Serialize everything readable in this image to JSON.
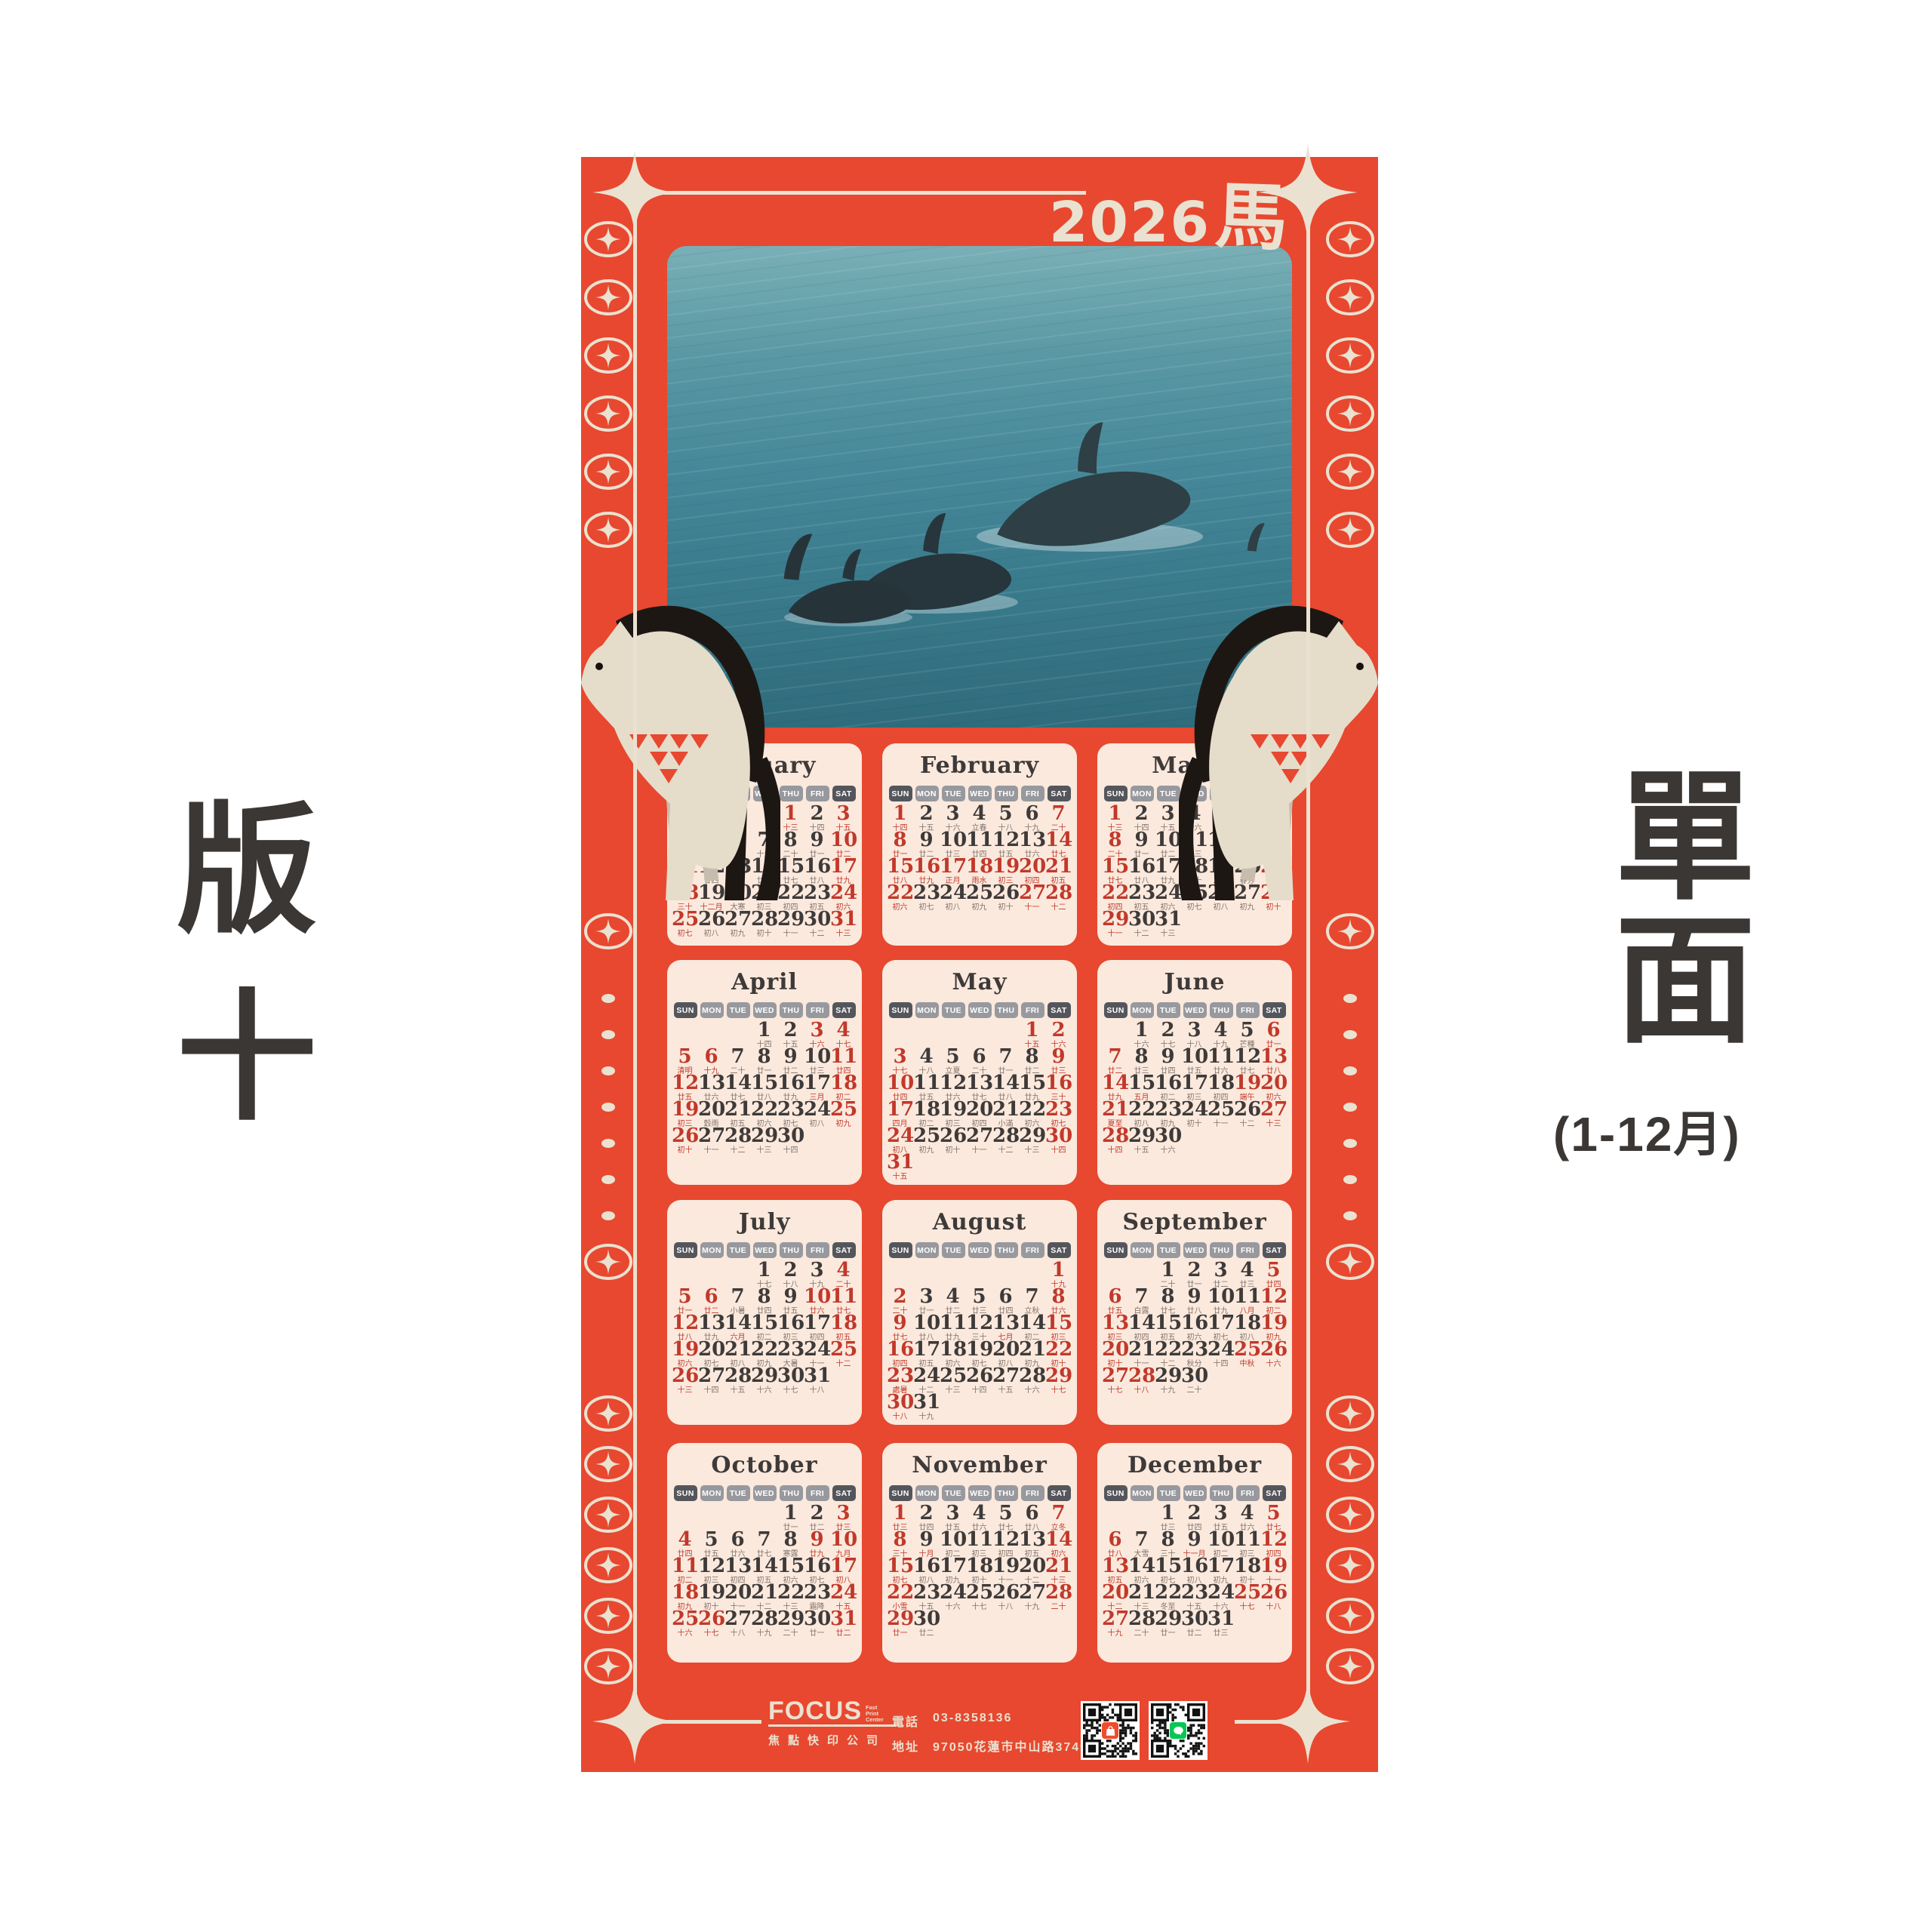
{
  "page": {
    "side_left": [
      "版",
      "十"
    ],
    "side_right": [
      "單",
      "面"
    ],
    "side_right_note": "(1-12月)"
  },
  "poster": {
    "year": "2026",
    "zodiac": "馬"
  },
  "weekdays": [
    "SUN",
    "MON",
    "TUE",
    "WED",
    "THU",
    "FRI",
    "SAT"
  ],
  "months": [
    {
      "name": "January",
      "first_dow": 4,
      "days": 31,
      "red": [
        1,
        3,
        4,
        10,
        11,
        17,
        18,
        24,
        25,
        31
      ],
      "lunar": [
        "十三",
        "十四",
        "十五",
        "十六",
        "十七",
        "十八",
        "十九",
        "二十",
        "廿一",
        "廿二",
        "廿三",
        "廿四",
        "廿五",
        "廿六",
        "廿七",
        "廿八",
        "廿九",
        "三十",
        "十二月",
        "大寒",
        "初三",
        "初四",
        "初五",
        "初六",
        "初七",
        "初八",
        "初九",
        "初十",
        "十一",
        "十二",
        "十三"
      ]
    },
    {
      "name": "February",
      "first_dow": 0,
      "days": 28,
      "red": [
        1,
        7,
        8,
        14,
        15,
        16,
        17,
        18,
        19,
        20,
        21,
        22,
        27,
        28
      ],
      "lunar": [
        "十四",
        "十五",
        "十六",
        "立春",
        "十八",
        "十九",
        "二十",
        "廿一",
        "廿二",
        "廿三",
        "廿四",
        "廿五",
        "廿六",
        "廿七",
        "廿八",
        "廿九",
        "正月",
        "雨水",
        "初三",
        "初四",
        "初五",
        "初六",
        "初七",
        "初八",
        "初九",
        "初十",
        "十一",
        "十二"
      ]
    },
    {
      "name": "March",
      "first_dow": 0,
      "days": 31,
      "red": [
        1,
        7,
        8,
        14,
        15,
        21,
        22,
        28,
        29
      ],
      "lunar": [
        "十三",
        "十四",
        "十五",
        "十六",
        "驚蟄",
        "十八",
        "十九",
        "二十",
        "廿一",
        "廿二",
        "廿三",
        "廿四",
        "廿五",
        "廿六",
        "廿七",
        "廿八",
        "廿九",
        "三十",
        "二月",
        "春分",
        "初三",
        "初四",
        "初五",
        "初六",
        "初七",
        "初八",
        "初九",
        "初十",
        "十一",
        "十二",
        "十三"
      ]
    },
    {
      "name": "April",
      "first_dow": 3,
      "days": 30,
      "red": [
        3,
        4,
        5,
        6,
        11,
        12,
        18,
        19,
        25,
        26
      ],
      "lunar": [
        "十四",
        "十五",
        "十六",
        "十七",
        "清明",
        "十九",
        "二十",
        "廿一",
        "廿二",
        "廿三",
        "廿四",
        "廿五",
        "廿六",
        "廿七",
        "廿八",
        "廿九",
        "三月",
        "初二",
        "初三",
        "穀雨",
        "初五",
        "初六",
        "初七",
        "初八",
        "初九",
        "初十",
        "十一",
        "十二",
        "十三",
        "十四"
      ]
    },
    {
      "name": "May",
      "first_dow": 5,
      "days": 31,
      "red": [
        1,
        2,
        3,
        9,
        10,
        16,
        17,
        23,
        24,
        30,
        31
      ],
      "lunar": [
        "十五",
        "十六",
        "十七",
        "十八",
        "立夏",
        "二十",
        "廿一",
        "廿二",
        "廿三",
        "廿四",
        "廿五",
        "廿六",
        "廿七",
        "廿八",
        "廿九",
        "三十",
        "四月",
        "初二",
        "初三",
        "初四",
        "小滿",
        "初六",
        "初七",
        "初八",
        "初九",
        "初十",
        "十一",
        "十二",
        "十三",
        "十四",
        "十五"
      ]
    },
    {
      "name": "June",
      "first_dow": 1,
      "days": 30,
      "red": [
        6,
        7,
        13,
        14,
        19,
        20,
        21,
        27,
        28
      ],
      "lunar": [
        "十六",
        "十七",
        "十八",
        "十九",
        "芒種",
        "廿一",
        "廿二",
        "廿三",
        "廿四",
        "廿五",
        "廿六",
        "廿七",
        "廿八",
        "廿九",
        "五月",
        "初二",
        "初三",
        "初四",
        "端午",
        "初六",
        "夏至",
        "初八",
        "初九",
        "初十",
        "十一",
        "十二",
        "十三",
        "十四",
        "十五",
        "十六"
      ]
    },
    {
      "name": "July",
      "first_dow": 3,
      "days": 31,
      "red": [
        4,
        5,
        6,
        10,
        11,
        12,
        18,
        19,
        25,
        26
      ],
      "lunar": [
        "十七",
        "十八",
        "十九",
        "二十",
        "廿一",
        "廿二",
        "小暑",
        "廿四",
        "廿五",
        "廿六",
        "廿七",
        "廿八",
        "廿九",
        "六月",
        "初二",
        "初三",
        "初四",
        "初五",
        "初六",
        "初七",
        "初八",
        "初九",
        "大暑",
        "十一",
        "十二",
        "十三",
        "十四",
        "十五",
        "十六",
        "十七",
        "十八"
      ]
    },
    {
      "name": "August",
      "first_dow": 6,
      "days": 31,
      "red": [
        1,
        2,
        8,
        9,
        15,
        16,
        22,
        23,
        29,
        30
      ],
      "lunar": [
        "十九",
        "二十",
        "廿一",
        "廿二",
        "廿三",
        "廿四",
        "立秋",
        "廿六",
        "廿七",
        "廿八",
        "廿九",
        "三十",
        "七月",
        "初二",
        "初三",
        "初四",
        "初五",
        "初六",
        "初七",
        "初八",
        "初九",
        "初十",
        "處暑",
        "十二",
        "十三",
        "十四",
        "十五",
        "十六",
        "十七",
        "十八",
        "十九"
      ]
    },
    {
      "name": "September",
      "first_dow": 2,
      "days": 30,
      "red": [
        5,
        6,
        12,
        13,
        19,
        20,
        25,
        26,
        27,
        28
      ],
      "lunar": [
        "二十",
        "廿一",
        "廿二",
        "廿三",
        "廿四",
        "廿五",
        "白露",
        "廿七",
        "廿八",
        "廿九",
        "八月",
        "初二",
        "初三",
        "初四",
        "初五",
        "初六",
        "初七",
        "初八",
        "初九",
        "初十",
        "十一",
        "十二",
        "秋分",
        "十四",
        "中秋",
        "十六",
        "十七",
        "十八",
        "十九",
        "二十"
      ]
    },
    {
      "name": "October",
      "first_dow": 4,
      "days": 31,
      "red": [
        3,
        4,
        9,
        10,
        11,
        17,
        18,
        24,
        25,
        26,
        31
      ],
      "lunar": [
        "廿一",
        "廿二",
        "廿三",
        "廿四",
        "廿五",
        "廿六",
        "廿七",
        "寒露",
        "廿九",
        "九月",
        "初二",
        "初三",
        "初四",
        "初五",
        "初六",
        "初七",
        "初八",
        "初九",
        "初十",
        "十一",
        "十二",
        "十三",
        "霜降",
        "十五",
        "十六",
        "十七",
        "十八",
        "十九",
        "二十",
        "廿一",
        "廿二"
      ]
    },
    {
      "name": "November",
      "first_dow": 0,
      "days": 30,
      "red": [
        1,
        7,
        8,
        14,
        15,
        21,
        22,
        28,
        29
      ],
      "lunar": [
        "廿三",
        "廿四",
        "廿五",
        "廿六",
        "廿七",
        "廿八",
        "立冬",
        "三十",
        "十月",
        "初二",
        "初三",
        "初四",
        "初五",
        "初六",
        "初七",
        "初八",
        "初九",
        "初十",
        "十一",
        "十二",
        "十三",
        "小雪",
        "十五",
        "十六",
        "十七",
        "十八",
        "十九",
        "二十",
        "廿一",
        "廿二"
      ]
    },
    {
      "name": "December",
      "first_dow": 2,
      "days": 31,
      "red": [
        5,
        6,
        12,
        13,
        19,
        20,
        25,
        26,
        27
      ],
      "lunar": [
        "廿三",
        "廿四",
        "廿五",
        "廿六",
        "廿七",
        "廿八",
        "大雪",
        "三十",
        "十一月",
        "初二",
        "初三",
        "初四",
        "初五",
        "初六",
        "初七",
        "初八",
        "初九",
        "初十",
        "十一",
        "十二",
        "十三",
        "冬至",
        "十五",
        "十六",
        "十七",
        "十八",
        "十九",
        "二十",
        "廿一",
        "廿二",
        "廿三"
      ]
    }
  ],
  "footer": {
    "logo": "FOCUS",
    "logo_sub": [
      "Fast",
      "Print",
      "Center"
    ],
    "company": "焦點快印公司",
    "phone_label": "電話",
    "phone": "03-8358136",
    "address_label": "地址",
    "address": "97050花蓮市中山路374號",
    "qr_icons": [
      "shopee-qr",
      "line-qr"
    ]
  },
  "colors": {
    "poster_red": "#E7482F",
    "cream": "#EBE1D0",
    "panel_bg": "#FBE9DD",
    "date_red": "#C1392B",
    "date_dark": "#3E3A39",
    "chip_gray": "#97999E",
    "chip_dark": "#55565C",
    "ocean_teal": "#47899A",
    "ink": "#3B3735",
    "shopee_orange": "#EE4D2D",
    "line_green": "#06C755"
  }
}
